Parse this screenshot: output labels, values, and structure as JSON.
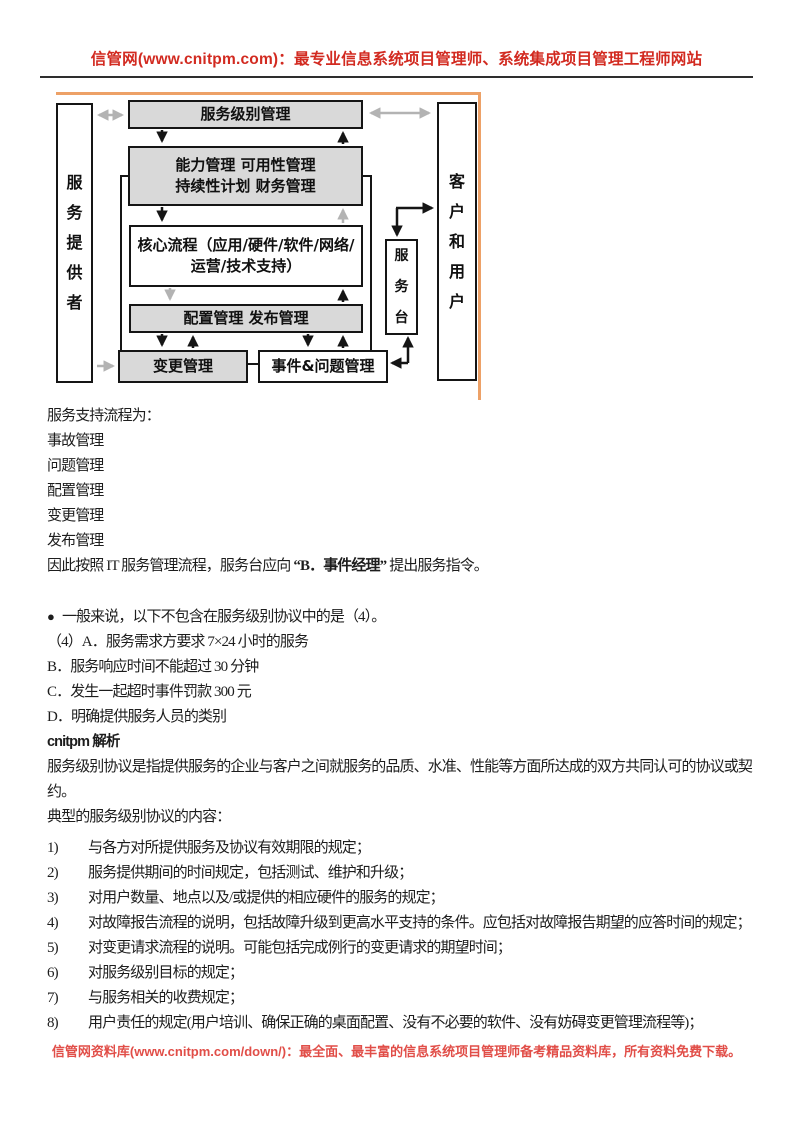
{
  "colors": {
    "header_red": "#d22a20",
    "footer_red": "#e14e48",
    "box_shaded_gray": "#d9d9d9",
    "diagram_border_black": "#151515",
    "orange_border": "#eda167",
    "arrow_gray": "#b3b3b3"
  },
  "header": {
    "title": "信管网(www.cnitpm.com)：最专业信息系统项目管理师、系统集成项目管理工程师网站"
  },
  "diagram": {
    "provider_label": "服务提供者",
    "customer_label": "客户和用户",
    "service_desk_label": "服务台",
    "slm_label": "服务级别管理",
    "tactical_line1": "能力管理 可用性管理",
    "tactical_line2": "持续性计划 财务管理",
    "core_label": "核心流程（应用/硬件/软件/网络/运营/技术支持）",
    "config_label": "配置管理 发布管理",
    "change_label": "变更管理",
    "incident_label": "事件&问题管理"
  },
  "body": {
    "intro": {
      "title": "服务支持流程为：",
      "items": [
        "事故管理",
        "问题管理",
        "配置管理",
        "变更管理",
        "发布管理"
      ],
      "conclusion_prefix": "因此按照 IT 服务管理流程，服务台应向",
      "conclusion_bold": "“B．事件经理”",
      "conclusion_suffix": "提出服务指令。"
    },
    "question": {
      "bullet": "●",
      "text": "一般来说，以下不包含在服务级别协议中的是（4）。",
      "options": [
        "（4）A．服务需求方要求 7×24 小时的服务",
        "B．服务响应时间不能超过 30 分钟",
        "C．发生一起超时事件罚款 300 元",
        "D．明确提供服务人员的类别"
      ]
    },
    "analysis": {
      "title": "cnitpm 解析",
      "p1": "服务级别协议是指提供服务的企业与客户之间就服务的品质、水准、性能等方面所达成的双方共同认可的协议或契约。",
      "p2": "典型的服务级别协议的内容：",
      "list": [
        {
          "num": "1)",
          "text": "与各方对所提供服务及协议有效期限的规定；"
        },
        {
          "num": "2)",
          "text": "服务提供期间的时间规定，包括测试、维护和升级；"
        },
        {
          "num": "3)",
          "text": "对用户数量、地点以及/或提供的相应硬件的服务的规定；"
        },
        {
          "num": "4)",
          "text": "对故障报告流程的说明，包括故障升级到更高水平支持的条件。应包括对故障报告期望的应答时间的规定；"
        },
        {
          "num": "5)",
          "text": "对变更请求流程的说明。可能包括完成例行的变更请求的期望时间；"
        },
        {
          "num": "6)",
          "text": "对服务级别目标的规定；"
        },
        {
          "num": "7)",
          "text": "与服务相关的收费规定；"
        },
        {
          "num": "8)",
          "text": "用户责任的规定(用户培训、确保正确的桌面配置、没有不必要的软件、没有妨碍变更管理流程等)；"
        }
      ]
    }
  },
  "footer": {
    "text": "信管网资料库(www.cnitpm.com/down/)：最全面、最丰富的信息系统项目管理师备考精品资料库，所有资料免费下载。"
  }
}
